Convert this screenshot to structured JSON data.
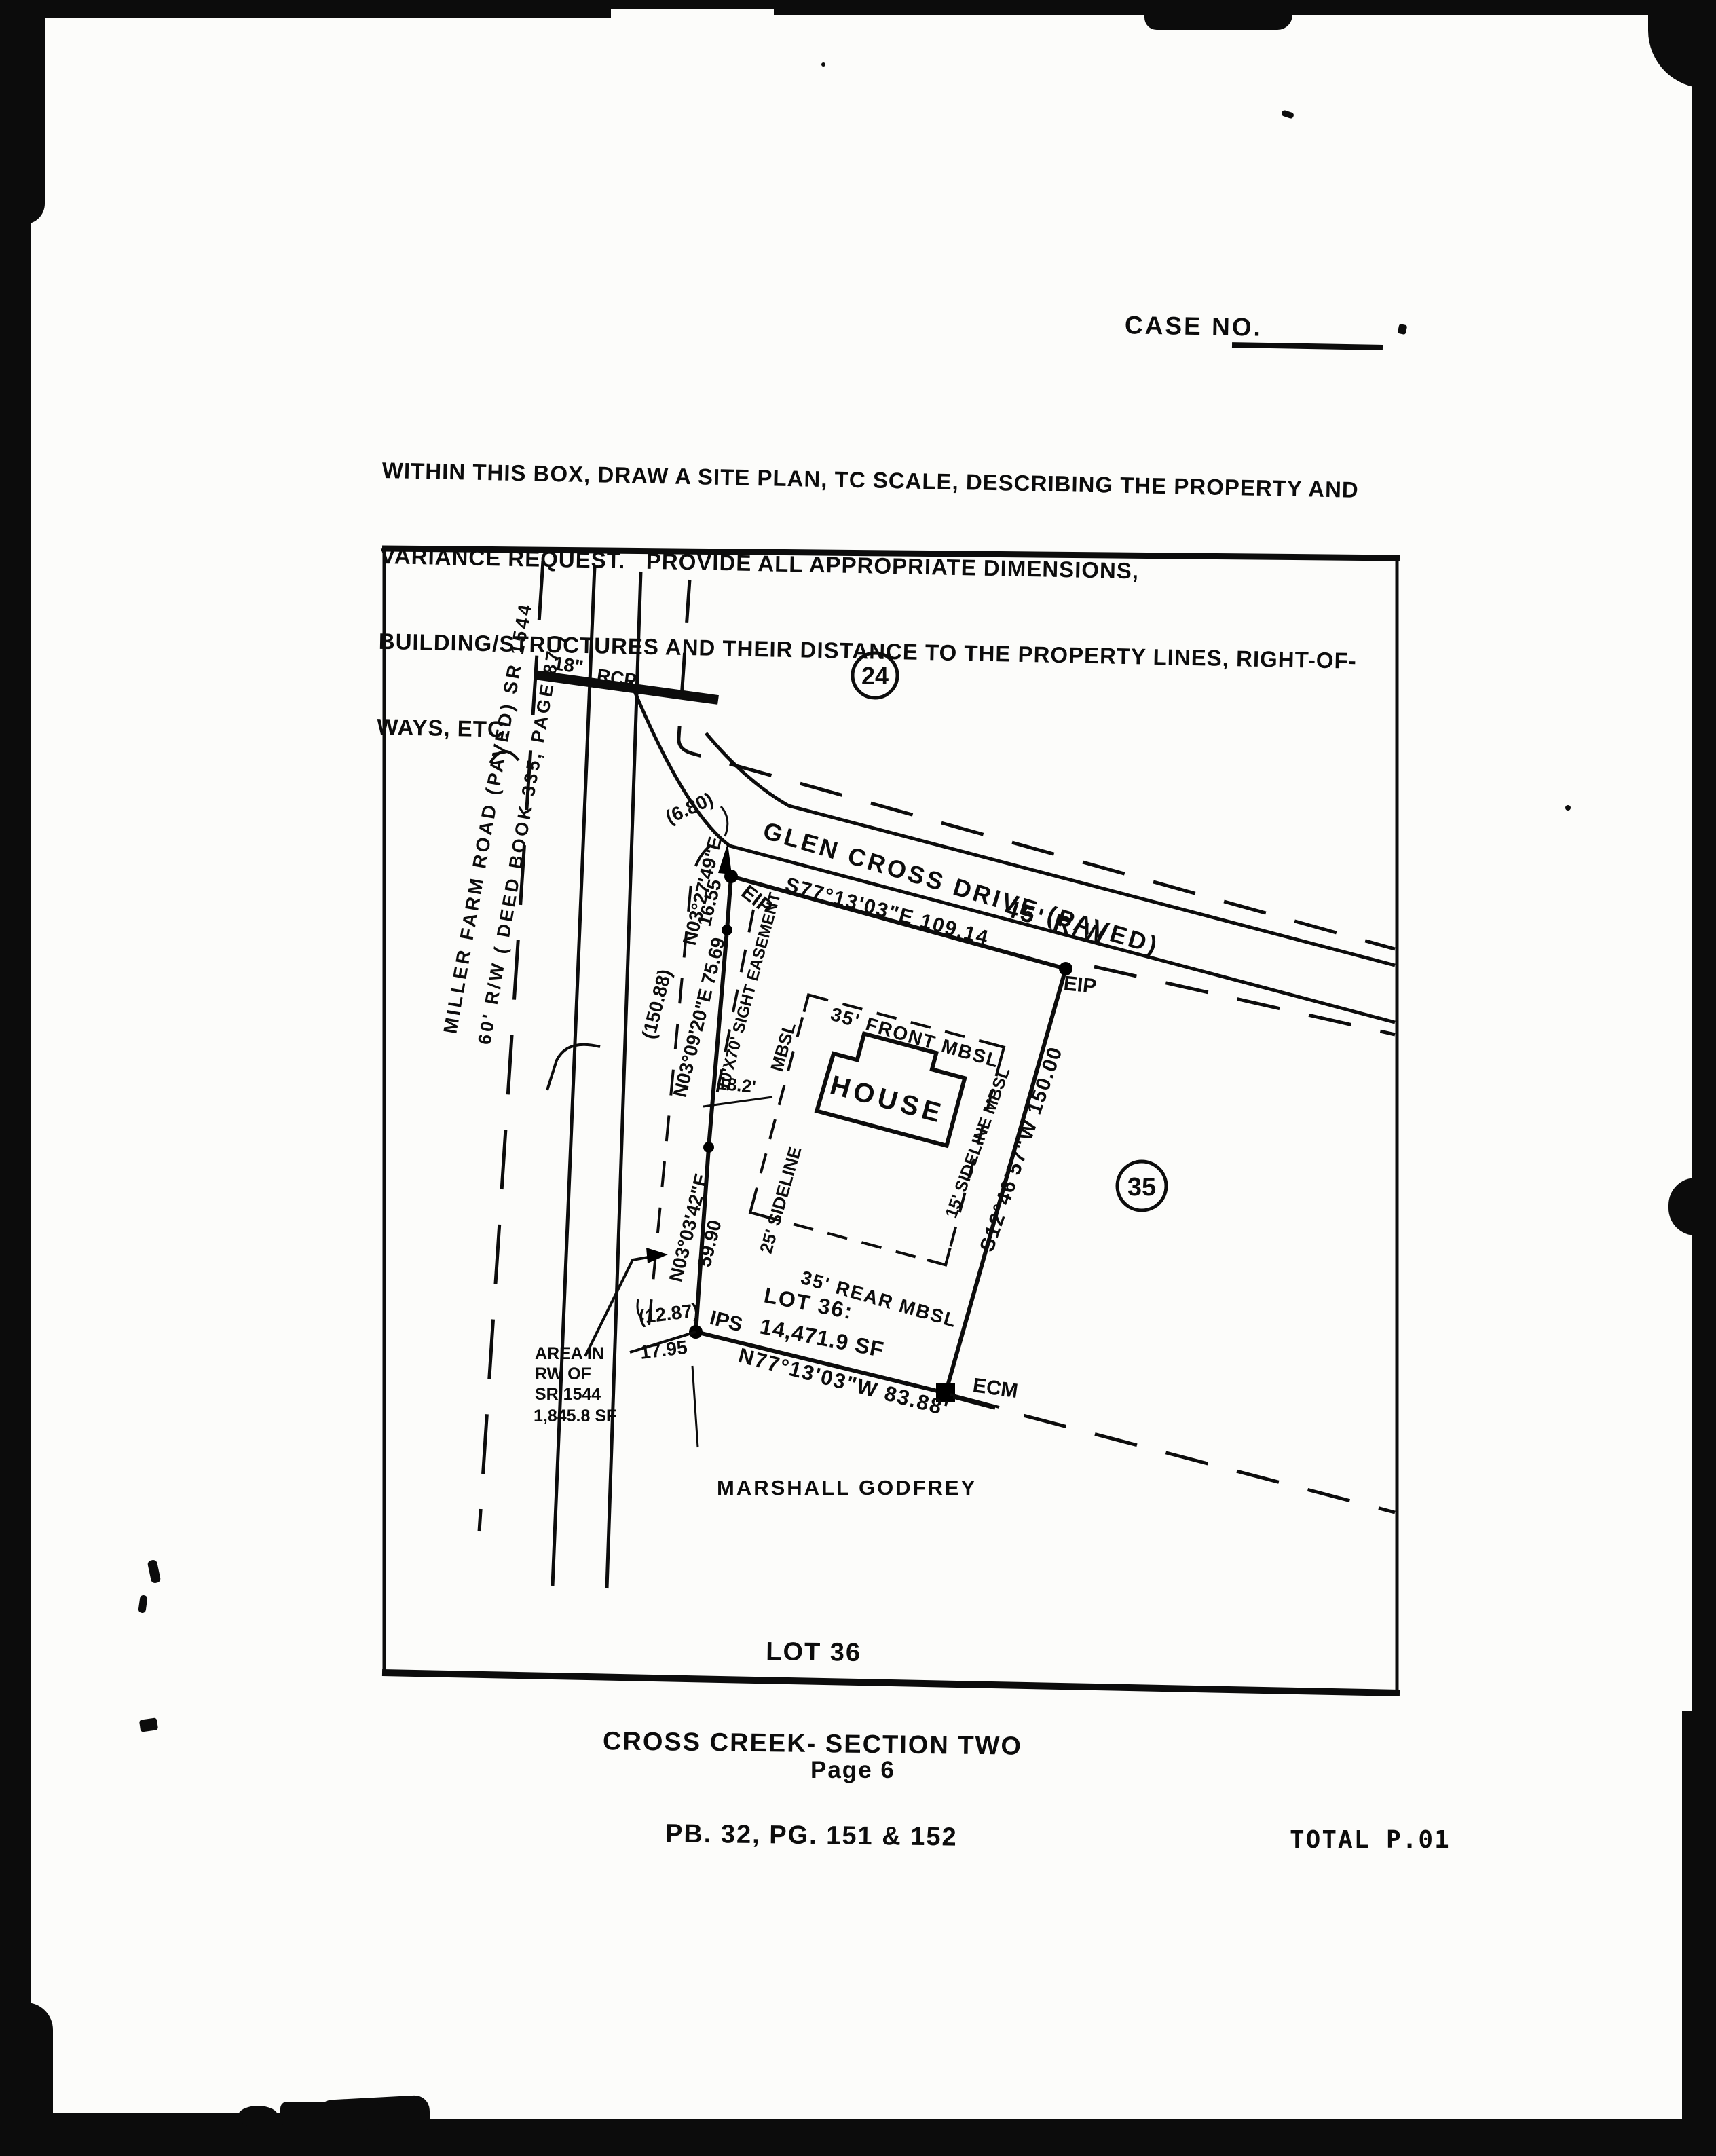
{
  "page": {
    "case_no_label": "CASE NO.",
    "instructions": {
      "line1": "WITHIN THIS BOX, DRAW A SITE PLAN, TC SCALE, DESCRIBING THE PROPERTY AND",
      "line2": "VARIANCE REQUEST.   PROVIDE ALL APPROPRIATE DIMENSIONS,",
      "line3": "BUILDING/STRUCTURES AND THEIR DISTANCE TO THE PROPERTY LINES, RIGHT-OF-",
      "line4": "WAYS, ETC."
    },
    "page_number": "Page 6",
    "fax_footer": "TOTAL P.01"
  },
  "plan": {
    "roads": {
      "miller_farm_line1": "MILLER FARM ROAD (PAVED)  SR 1544",
      "miller_farm_line2": "60' R/W  ( DEED BOOK 335, PAGE 87 )",
      "glen_cross_name": "GLEN CROSS DRIVE (PAVED)",
      "glen_cross_rw": "45' R/W",
      "culvert_size": "18\"",
      "culvert_type": "RCP"
    },
    "lot_numbers": {
      "north": "24",
      "east": "35"
    },
    "bearings": {
      "front": "S77°13'03\"E   109.14",
      "east": "S12°46'57\"W  150.00",
      "south": "N77°13'03\"W  83.88'",
      "west_upper": "N03°27'49\"E",
      "west_upper_dist": "16.55",
      "west_mid": "N03°09'20\"E  75.69",
      "west_lower": "N03°03'42\"E",
      "west_lower_dist": "59.90",
      "rw_total": "(150.88)",
      "corner_curve": "(6.80)",
      "tie_upper": "(12.87)",
      "tie_lower": "17.95"
    },
    "monuments": {
      "eip_nw": "EIP",
      "eip_ne": "EIP",
      "ips": "IPS",
      "ecm": "ECM"
    },
    "house": {
      "label": "HOUSE",
      "offset": "18.2'"
    },
    "setbacks": {
      "front": "35' FRONT MBSL",
      "left_mbsl": "MBSL",
      "left_sideline": "25' SIDELINE",
      "right_sideline": "15' SIDELINE MBSL",
      "rear": "35' REAR MBSL",
      "sight_easement": "10'X70' SIGHT EASEMENT"
    },
    "lot_area": {
      "line1": "LOT 36:",
      "line2": "14,471.9 SF"
    },
    "rw_area": {
      "line1": "AREA IN",
      "line2": "RW OF",
      "line3": "SR 1544",
      "line4": "1,845.8 SF"
    },
    "adjacent_owner": "MARSHALL GODFREY",
    "title": {
      "line1": "LOT 36",
      "line2": "CROSS CREEK- SECTION TWO",
      "line3": "PB. 32, PG. 151 & 152"
    }
  }
}
